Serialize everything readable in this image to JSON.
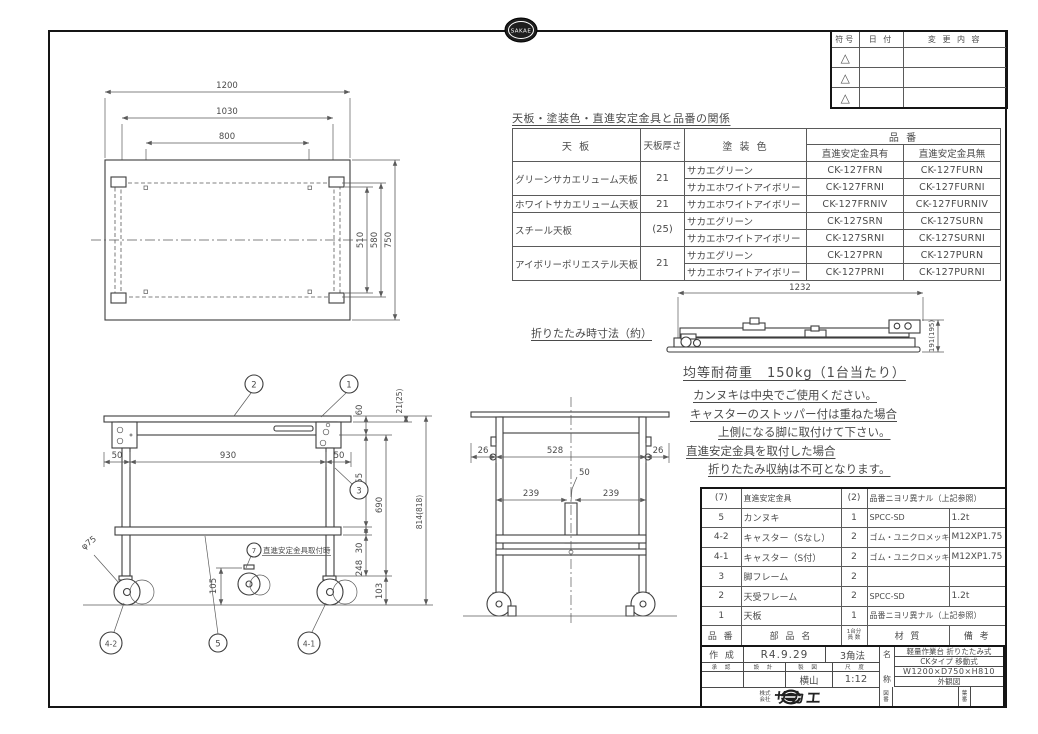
{
  "emblem": {
    "text": "SAKAE"
  },
  "revision_table": {
    "headers": {
      "sign": "符号",
      "date": "日  付",
      "change": "変 更 内 容"
    },
    "triangle": "△"
  },
  "relation_table": {
    "title": "天板・塗装色・直進安定金具と品番の関係",
    "header": {
      "top": "天  板",
      "thk": "天板厚さ",
      "color": "塗  装  色",
      "hinban": "品  番",
      "with_b": "直進安定金具有",
      "without_b": "直進安定金具無"
    },
    "rows": [
      {
        "top": "グリーンサカエリューム天板",
        "thk": "21",
        "color": "サカエグリーン",
        "w": "CK-127FRN",
        "wo": "CK-127FURN"
      },
      {
        "top": "",
        "thk": "",
        "color": "サカエホワイトアイボリー",
        "w": "CK-127FRNI",
        "wo": "CK-127FURNI"
      },
      {
        "top": "ホワイトサカエリューム天板",
        "thk": "21",
        "color": "サカエホワイトアイボリー",
        "w": "CK-127FRNIV",
        "wo": "CK-127FURNIV"
      },
      {
        "top": "スチール天板",
        "thk": "(25)",
        "color": "サカエグリーン",
        "w": "CK-127SRN",
        "wo": "CK-127SURN"
      },
      {
        "top": "",
        "thk": "",
        "color": "サカエホワイトアイボリー",
        "w": "CK-127SRNI",
        "wo": "CK-127SURNI"
      },
      {
        "top": "アイボリーポリエステル天板",
        "thk": "21",
        "color": "サカエグリーン",
        "w": "CK-127PRN",
        "wo": "CK-127PURN"
      },
      {
        "top": "",
        "thk": "",
        "color": "サカエホワイトアイボリー",
        "w": "CK-127PRNI",
        "wo": "CK-127PURNI"
      }
    ]
  },
  "notes": {
    "folded_label": "折りたたみ時寸法（約）",
    "load": "均等耐荷重　150kg（1台当たり）",
    "lines": [
      "カンヌキは中央でご使用ください。",
      "キャスターのストッパー付は重ねた場合",
      "上側になる脚に取付けて下さい。",
      "直進安定金具を取付した場合",
      "折りたたみ収納は不可となります。"
    ]
  },
  "dims": {
    "top_view": {
      "w1": "1200",
      "w2": "1030",
      "w3": "800",
      "d1": "510",
      "d2": "580",
      "d3": "750"
    },
    "folded": {
      "w": "1232",
      "h": "191(195)"
    },
    "front": {
      "l50": "50",
      "c930": "930",
      "r50": "50",
      "h105": "105",
      "dia": "φ75",
      "h60": "60",
      "h455": "455",
      "h30": "30",
      "h248": "248",
      "h690": "690",
      "h103": "103",
      "t21": "21(25)",
      "h814": "814(818)",
      "anchor_note": "直進安定金具取付時"
    },
    "side": {
      "l26": "26",
      "c528": "528",
      "r26": "26",
      "s50": "50",
      "l239": "239",
      "r239": "239"
    }
  },
  "balloons": {
    "b1": "1",
    "b2": "2",
    "b3": "3",
    "b5": "5",
    "b41": "4-1",
    "b42": "4-2",
    "b7": "7"
  },
  "parts_table": {
    "headers": {
      "no": "品 番",
      "name": "部 品 名",
      "qty1": "1台分",
      "qty2": "員 数",
      "material": "材  質",
      "remarks": "備  考"
    },
    "rows": [
      {
        "no": "(7)",
        "name": "直進安定金具",
        "qty": "(2)",
        "material": "品番ニヨリ異ナル（上記参照）",
        "remarks": ""
      },
      {
        "no": "5",
        "name": "カンヌキ",
        "qty": "1",
        "material": "SPCC-SD",
        "remarks": "1.2t"
      },
      {
        "no": "4-2",
        "name": "キャスター（Sなし）",
        "qty": "2",
        "material": "ゴム・ユニクロメッキ",
        "remarks": "M12XP1.75"
      },
      {
        "no": "4-1",
        "name": "キャスター（S付）",
        "qty": "2",
        "material": "ゴム・ユニクロメッキ",
        "remarks": "M12XP1.75"
      },
      {
        "no": "3",
        "name": "脚フレーム",
        "qty": "2",
        "material": "",
        "remarks": ""
      },
      {
        "no": "2",
        "name": "天受フレーム",
        "qty": "2",
        "material": "SPCC-SD",
        "remarks": "1.2t"
      },
      {
        "no": "1",
        "name": "天板",
        "qty": "1",
        "material": "品番ニヨリ異ナル（上記参照）",
        "remarks": ""
      }
    ]
  },
  "title_block": {
    "created_label": "作 成",
    "created_date": "R4.9.29",
    "projection": "3角法",
    "approve": "承 認",
    "design": "設 計",
    "draft": "製 図",
    "scale_label": "尺 度",
    "drafter": "横山",
    "scale": "1:12",
    "name_label_1": "名",
    "name_label_2": "称",
    "name_line1": "軽量作業台 折りたたみ式",
    "name_line2": "CKタイプ 移動式",
    "name_line3": "W1200×D750×H810",
    "name_line4": "外観図",
    "company_prefix1": "株式",
    "company_prefix2": "会社",
    "company": "サカエ",
    "zuban_1": "図",
    "zuban_2": "番",
    "haban_1": "葉",
    "haban_2": "番"
  }
}
